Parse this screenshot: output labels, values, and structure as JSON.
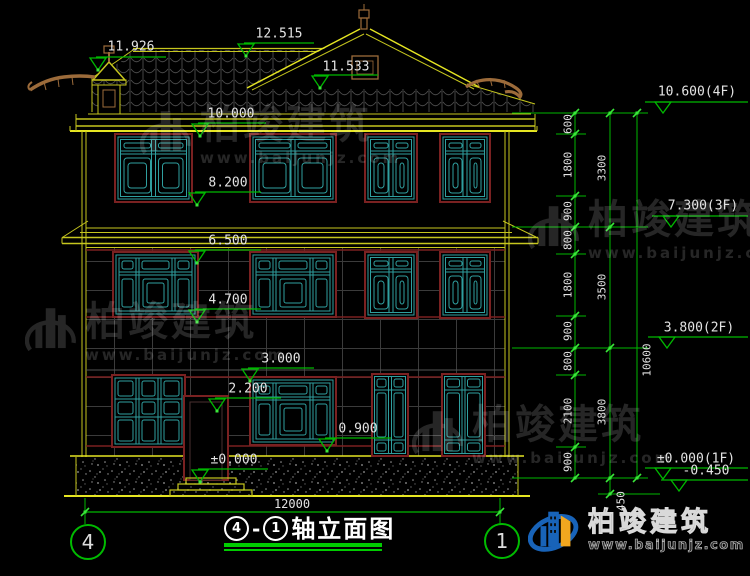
{
  "drawing": {
    "title": {
      "axis_left": "4",
      "dash": "-",
      "axis_right": "1",
      "name": "轴立面图"
    },
    "axis_bubbles": {
      "left": "4",
      "right": "1"
    },
    "left_markers": [
      {
        "value": "11.926"
      },
      {
        "value": "12.515"
      },
      {
        "value": "11.533"
      },
      {
        "value": "10.000"
      },
      {
        "value": "8.200"
      },
      {
        "value": "6.500"
      },
      {
        "value": "4.700"
      },
      {
        "value": "3.000"
      },
      {
        "value": "2.200"
      },
      {
        "value": "0.900"
      },
      {
        "value": "±0.000"
      }
    ],
    "right_markers": [
      {
        "value": "10.600(4F)"
      },
      {
        "value": "7.300(3F)"
      },
      {
        "value": "3.800(2F)"
      },
      {
        "value": "±0.000(1F)"
      },
      {
        "value": "-0.450"
      }
    ],
    "dims": {
      "chain": [
        "600",
        "1800",
        "900",
        "800",
        "1800",
        "900",
        "800",
        "2100",
        "900"
      ],
      "floors": [
        "3300",
        "3500",
        "3800"
      ],
      "total": "10600",
      "below_grade": "450",
      "width": "12000"
    }
  },
  "watermark": {
    "brand": "柏竣建筑",
    "url": "www.baijunjz.com"
  },
  "logo": {
    "brand": "柏竣建筑",
    "url": "www.baijunjz.com"
  },
  "colors": {
    "line_yellow": "#c6c61e",
    "bright_yellow": "#e6e622",
    "window_teal": "#2f9f9f",
    "frame_maroon": "#7a2121",
    "dim_green": "#00b800",
    "ornament_brown": "#9c6b3a",
    "text_white": "#e3e3e3"
  }
}
